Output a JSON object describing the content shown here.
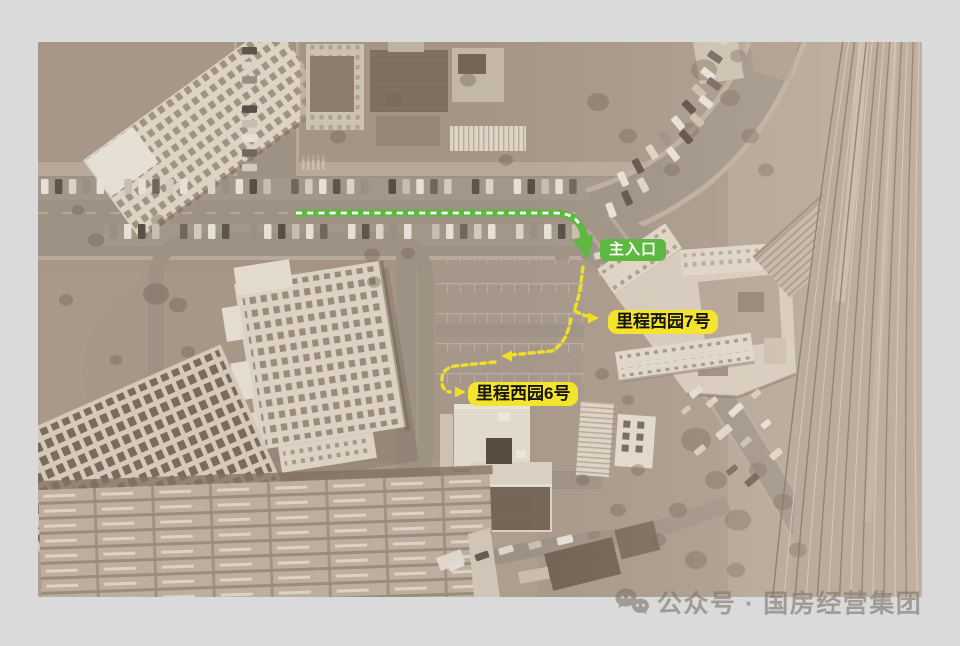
{
  "page": {
    "background_color": "#dadada"
  },
  "labels": {
    "main_entrance": {
      "text": "主入口",
      "bg_color": "#5cb83e",
      "text_color": "#ffffff"
    },
    "building_7": {
      "text": "里程西园7号",
      "bg_color": "#f4e42e",
      "text_color": "#141414"
    },
    "building_6": {
      "text": "里程西园6号",
      "bg_color": "#f4e42e",
      "text_color": "#141414"
    }
  },
  "routes": {
    "entrance_route_color": "#5cb83e",
    "entrance_route_dash_color": "#ffffff",
    "internal_route_color": "#f0df25"
  },
  "watermark": {
    "icon": "wechat-icon",
    "text": "公众号 · 国房经营集团",
    "color": "#7d766e"
  }
}
